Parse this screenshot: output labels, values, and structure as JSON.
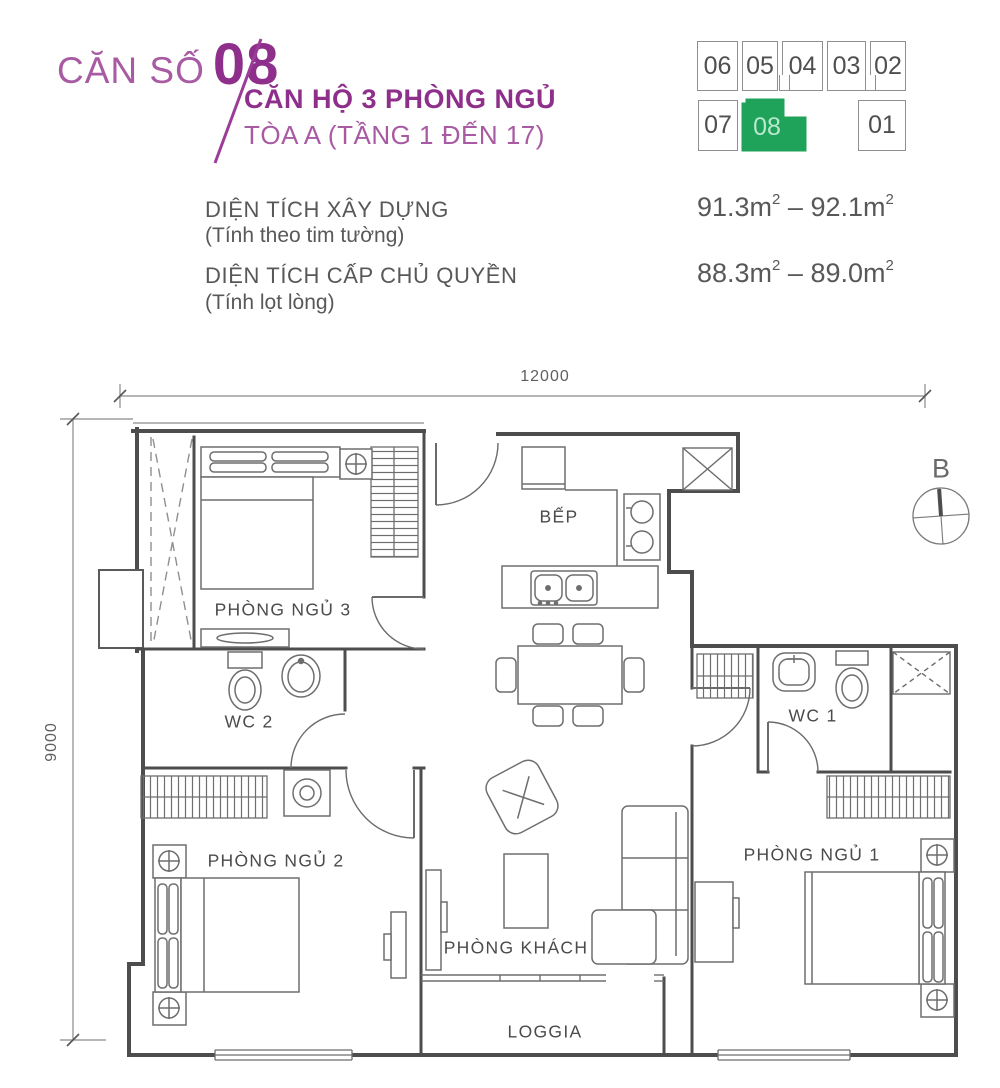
{
  "header": {
    "unit_label": "CĂN SỐ",
    "unit_number": "08",
    "title": "CĂN HỘ 3 PHÒNG NGỦ",
    "subtitle": "TÒA A (TẦNG 1 ĐẾN 17)"
  },
  "minimap": {
    "units": [
      "06",
      "05",
      "04",
      "03",
      "02",
      "07",
      "08",
      "01"
    ],
    "highlighted_unit": "08",
    "highlight_color": "#1fa35a"
  },
  "areas": [
    {
      "label": "DIỆN TÍCH XÂY DỰNG",
      "note": "(Tính theo tim tường)",
      "from": "91.3m",
      "sup": "2",
      "dash": "–",
      "to": "92.1m"
    },
    {
      "label": "DIỆN TÍCH CẤP CHỦ QUYỀN",
      "note": "(Tính lọt lòng)",
      "from": "88.3m",
      "sup": "2",
      "dash": "–",
      "to": "89.0m"
    }
  ],
  "plan": {
    "dim_width": "12000",
    "dim_height": "9000",
    "compass_label": "B",
    "rooms": [
      {
        "id": "bedroom3",
        "label": "PHÒNG NGỦ 3"
      },
      {
        "id": "wc2",
        "label": "WC 2"
      },
      {
        "id": "bedroom2",
        "label": "PHÒNG NGỦ 2"
      },
      {
        "id": "kitchen",
        "label": "BẾP"
      },
      {
        "id": "living",
        "label": "PHÒNG KHÁCH"
      },
      {
        "id": "loggia",
        "label": "LOGGIA"
      },
      {
        "id": "wc1",
        "label": "WC 1"
      },
      {
        "id": "bedroom1",
        "label": "PHÒNG NGỦ 1"
      }
    ]
  },
  "colors": {
    "accent": "#8e2f8b",
    "accent_light": "#a85ba3",
    "highlight_green": "#1fa35a",
    "wall": "#4d4d4d",
    "furniture_line": "#6e6e6e",
    "text": "#585858"
  }
}
